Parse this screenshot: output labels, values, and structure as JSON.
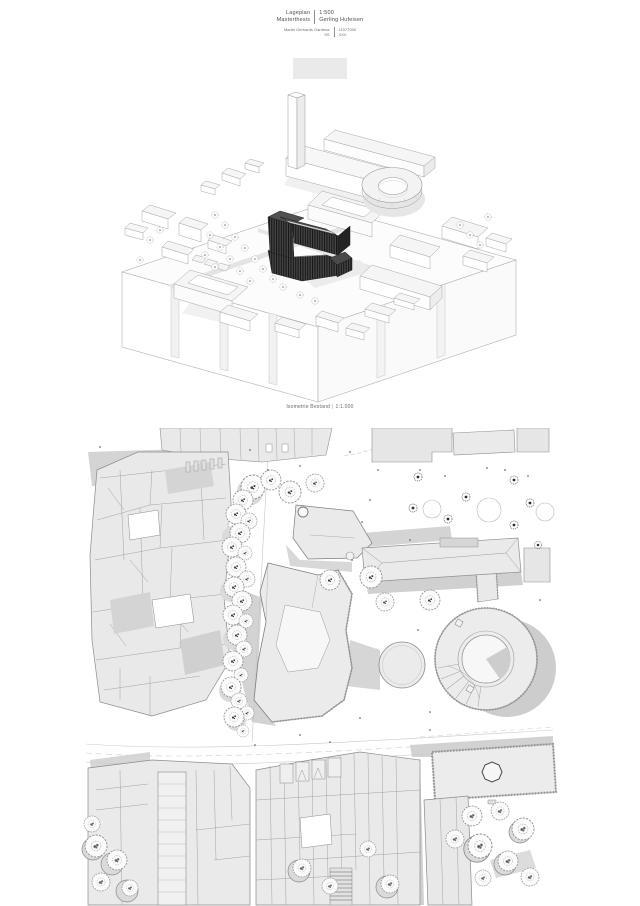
{
  "title_block": {
    "row1": {
      "left": "Lageplan",
      "right": "1:500"
    },
    "row2": {
      "left": "Masterthesis",
      "right": "Gerling Hufeisen"
    },
    "row3": {
      "left": "Martin Gerhards Gardena",
      "right": "11977000"
    },
    "row4": {
      "left": "SS",
      "right": "XXV"
    }
  },
  "isometric_figure": {
    "caption": "Isometrie Bestand",
    "separator": "|",
    "scale": "1:1.000"
  },
  "colors": {
    "paper": "#ffffff",
    "linework": "#8f8f8f",
    "building_fill": "#e9e9e9",
    "shadow": "#cfcfcf",
    "design_building": "#3a3a3a",
    "text": "#5a5a5a"
  }
}
